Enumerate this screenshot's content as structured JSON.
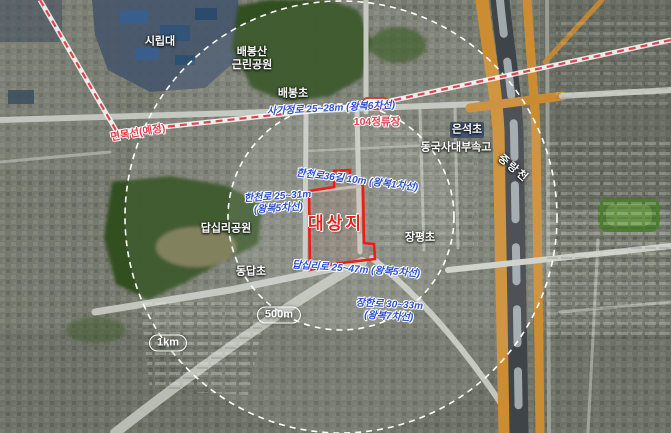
{
  "map_type": "satellite-location-map",
  "site": {
    "label": "대상지"
  },
  "rings": {
    "inner": "500m",
    "outer": "1km"
  },
  "transit": {
    "planned_line": "면목선(예정)",
    "station": "104정류장",
    "station_icon": "rail-station-icon"
  },
  "places": [
    {
      "id": "uos-campus",
      "label": "시립대"
    },
    {
      "id": "baebongsan-park",
      "label": "배봉산\n근린공원"
    },
    {
      "id": "baebong-elementary",
      "label": "배봉초"
    },
    {
      "id": "eunseok-elementary",
      "label": "은석초"
    },
    {
      "id": "dongguk-univ-highschool",
      "label": "동국사대부속고"
    },
    {
      "id": "jungnang-stream",
      "label": "중랑천"
    },
    {
      "id": "dapsimni-park",
      "label": "답십리공원"
    },
    {
      "id": "jangpyeong-elementary",
      "label": "장평초"
    },
    {
      "id": "dongdap-elementary",
      "label": "동답초"
    }
  ],
  "roads": [
    {
      "id": "sagajeong-ro",
      "label": "사가정로 25~28m (왕복6차선)"
    },
    {
      "id": "hancheonro-36gil",
      "label": "한천로36길 10m (왕복1차선)"
    },
    {
      "id": "hancheon-ro",
      "label": "한천로 25~31m\n(왕복5차선)"
    },
    {
      "id": "dapsimni-ro",
      "label": "답십리로 25~47m (왕복5차선)"
    },
    {
      "id": "janghan-ro",
      "label": "장한로 30~33m\n(왕복7차선)"
    }
  ],
  "colors": {
    "site_outline": "#ee1c16",
    "road_label_blue": "#2b4fd0",
    "transit_red": "#e33c4c",
    "ring_white": "#ffffff",
    "park_green": "#2e4c1e",
    "highway_orange": "#cc8c32",
    "river_dark": "#3f4449"
  }
}
